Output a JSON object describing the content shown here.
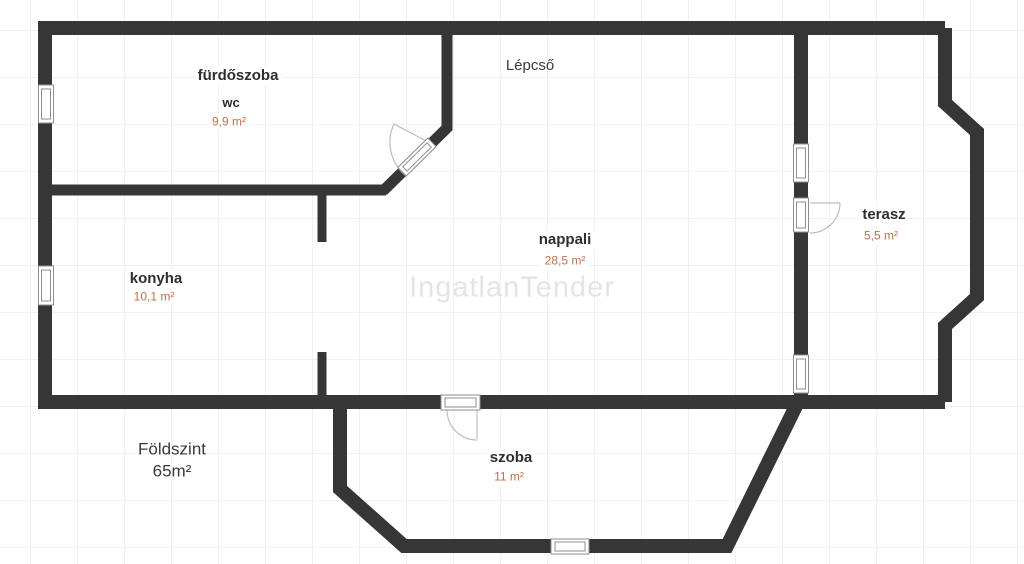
{
  "watermark": "IngatlanTender",
  "plan": {
    "floor": {
      "label": "Földszint",
      "area": "65m²"
    },
    "rooms": [
      {
        "name": "fürdőszoba",
        "sub": "wc",
        "area": "9,9 m²"
      },
      {
        "name": "Lépcső"
      },
      {
        "name": "konyha",
        "area": "10,1 m²"
      },
      {
        "name": "nappali",
        "area": "28,5 m²"
      },
      {
        "name": "terasz",
        "area": "5,5 m²"
      },
      {
        "name": "szoba",
        "area": "11 m²"
      }
    ]
  },
  "colors": {
    "wall": "#363636",
    "area_text": "#bf6f4d",
    "room_text": "#2e2e2e",
    "watermark": "#e4e4e4",
    "symbol_stroke": "#8f8f8f",
    "swing_stroke": "#bdbdbd"
  }
}
